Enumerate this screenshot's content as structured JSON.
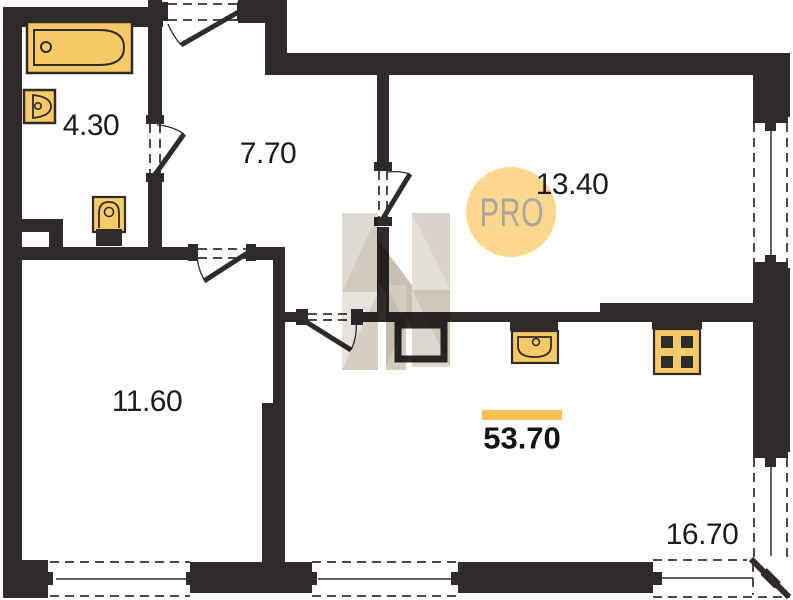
{
  "plan": {
    "logo_text": "PRO",
    "total_area": "53.70",
    "rooms": {
      "bathroom": {
        "area": "4.30"
      },
      "hallway": {
        "area": "7.70"
      },
      "kitchen_zone": {
        "area": "13.40"
      },
      "bedroom": {
        "area": "11.60"
      },
      "living_zone": {
        "area": "16.70"
      }
    },
    "fixtures": [
      "bathtub-icon",
      "washbasin-icon",
      "toilet-icon",
      "kitchen-sink-icon",
      "stove-icon"
    ],
    "colors": {
      "wall": "#2f2b28",
      "fixture_fill": "#f8c967",
      "accent_bar": "#f6c155",
      "logo_circle": "#fbd88e",
      "logo_text": "#a8a49e",
      "watermark_light": "#e5e1da",
      "watermark_mid": "#d5cec3",
      "watermark_dark": "#c6bdaf"
    }
  }
}
